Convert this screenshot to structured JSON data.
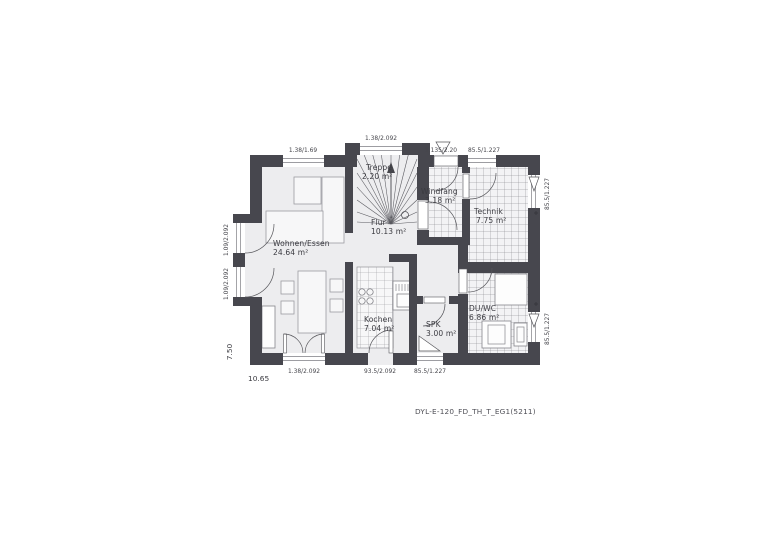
{
  "colors": {
    "wall": "#47474e",
    "floor": "#ededef",
    "tile_floor": "#f3f3f5",
    "tile_line": "#7c7c82",
    "annotation_text": "#3b3b41"
  },
  "rooms": {
    "wohnen_essen": {
      "name": "Wohnen/Essen",
      "area": "24.64 m²"
    },
    "treppe": {
      "name": "Treppe",
      "area": "2.20 m²"
    },
    "flur": {
      "name": "Flur",
      "area": "10.13 m²"
    },
    "windfang": {
      "name": "Windfang",
      "area": "3.18 m²"
    },
    "technik": {
      "name": "Technik",
      "area": "7.75 m²"
    },
    "kochen": {
      "name": "Kochen",
      "area": "7.04 m²"
    },
    "spk": {
      "name": "SPK",
      "area": "3.00 m²"
    },
    "du_wc": {
      "name": "DU/WC",
      "area": "6.86 m²"
    }
  },
  "dimensions": {
    "top_living_window": "1.38/1.69",
    "top_stair_window": "1.38/2.092",
    "entrance_door": "1.135/2.20",
    "top_technik_window": "85.5/1.227",
    "right_technik_window": "85.5/1.227",
    "right_duwc_window": "85.5/1.227",
    "left_upper_window": "1.09/2.092",
    "left_lower_window": "1.09/2.092",
    "bottom_terrace_door": "1.38/2.092",
    "bottom_kitchen_door": "93.5/2.092",
    "bottom_spk_window": "85.5/1.227",
    "overall_width": "10.65",
    "overall_depth": "7.50"
  },
  "caption": "DYL-E-120_FD_TH_T_EG1(5211)"
}
